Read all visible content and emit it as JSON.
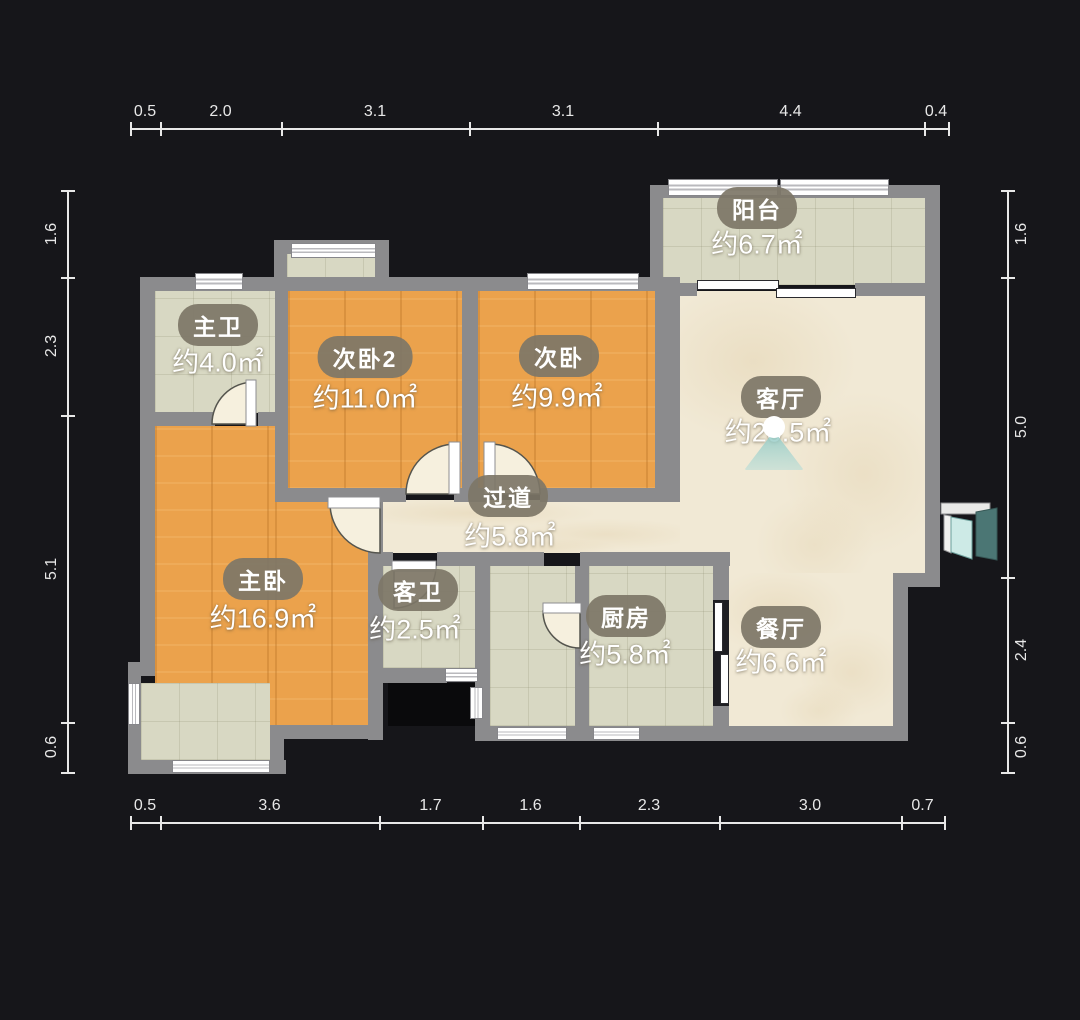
{
  "app": {
    "type": "floorplan-viewer"
  },
  "palette": {
    "background": "#16161a",
    "wall": "#8b8b8d",
    "wood_floor": "#eba24c",
    "tile_floor": "#d8d8c3",
    "marble_floor": "#f1e9d5",
    "label_pill": "#7d7667",
    "dimension_text": "#e8e8e8",
    "camera_fan": "#a8d6d1",
    "entry_door": "#4b7674"
  },
  "rooms": [
    {
      "id": "balcony",
      "name": "阳台",
      "area": "约6.7㎡"
    },
    {
      "id": "master-bath",
      "name": "主卫",
      "area": "约4.0㎡"
    },
    {
      "id": "bedroom2",
      "name": "次卧2",
      "area": "约11.0㎡"
    },
    {
      "id": "bedroom",
      "name": "次卧",
      "area": "约9.9㎡"
    },
    {
      "id": "living-room",
      "name": "客厅",
      "area": "约20.5㎡"
    },
    {
      "id": "hallway",
      "name": "过道",
      "area": "约5.8㎡"
    },
    {
      "id": "master-bedroom",
      "name": "主卧",
      "area": "约16.9㎡"
    },
    {
      "id": "guest-bath",
      "name": "客卫",
      "area": "约2.5㎡"
    },
    {
      "id": "kitchen",
      "name": "厨房",
      "area": "约5.8㎡"
    },
    {
      "id": "dining-room",
      "name": "餐厅",
      "area": "约6.6㎡"
    }
  ],
  "dimensions": {
    "top": {
      "orient": "h",
      "line": 128,
      "ticks": [
        130,
        160,
        281,
        469,
        657,
        924,
        948
      ],
      "labels": [
        "0.5",
        "2.0",
        "3.1",
        "3.1",
        "4.4",
        "0.4"
      ],
      "label_off": -16
    },
    "bottom": {
      "orient": "h",
      "line": 822,
      "ticks": [
        130,
        160,
        379,
        482,
        579,
        719,
        901,
        944
      ],
      "labels": [
        "0.5",
        "3.6",
        "1.7",
        "1.6",
        "2.3",
        "3.0",
        "0.7"
      ],
      "label_off": -16
    },
    "left": {
      "orient": "v",
      "line": 67,
      "ticks": [
        190,
        277,
        415,
        722,
        772
      ],
      "labels": [
        "1.6",
        "2.3",
        "5.1",
        "0.6"
      ],
      "label_off": -15
    },
    "right": {
      "orient": "v",
      "line": 1007,
      "ticks": [
        190,
        277,
        577,
        722,
        772
      ],
      "labels": [
        "1.6",
        "5.0",
        "2.4",
        "0.6"
      ],
      "label_off": 15
    }
  }
}
